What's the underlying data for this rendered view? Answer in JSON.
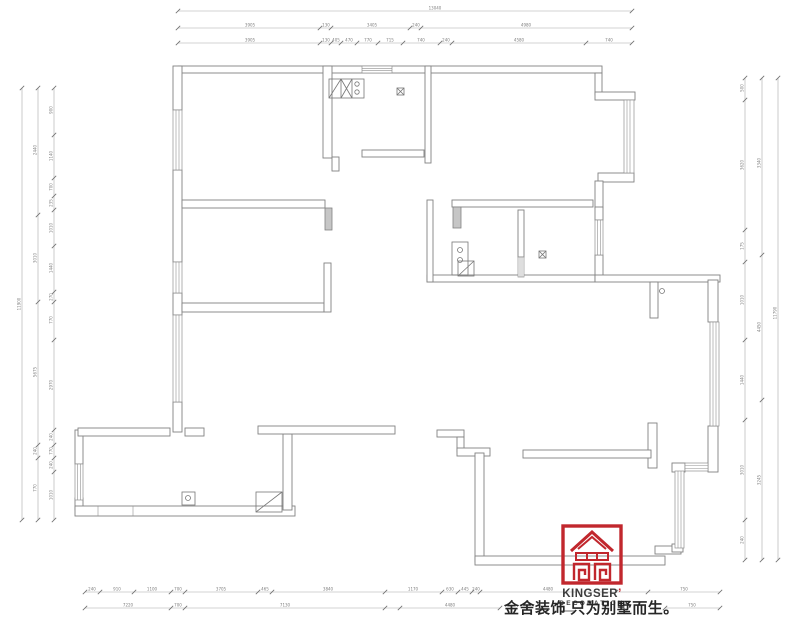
{
  "branding": {
    "logo_text_primary": "KINGSER",
    "logo_mark": "’",
    "logo_text_secondary": "DECORATION",
    "slogan": "金舍装饰 只为别墅而生。",
    "brand_red": "#c1272d",
    "text_dark": "#3d3d3d"
  },
  "floor_plan": {
    "wall_line_color": "#828282",
    "dimension_color": "#808080",
    "dimension_lines": [
      {
        "orient": "h",
        "at": 11,
        "from": 178,
        "to": 632,
        "ticks": [
          178,
          632
        ],
        "labels": [
          {
            "t": "13040",
            "pos": 435
          }
        ]
      },
      {
        "orient": "h",
        "at": 28,
        "from": 178,
        "to": 632,
        "ticks": [
          178,
          320,
          331,
          410,
          421,
          632
        ],
        "labels": [
          {
            "t": "3905",
            "pos": 250
          },
          {
            "t": "130",
            "pos": 326
          },
          {
            "t": "3405",
            "pos": 372
          },
          {
            "t": "240",
            "pos": 416
          },
          {
            "t": "4980",
            "pos": 526
          }
        ]
      },
      {
        "orient": "h",
        "at": 43,
        "from": 178,
        "to": 632,
        "ticks": [
          178,
          320,
          331,
          341,
          357,
          378,
          403,
          440,
          452,
          586,
          632
        ],
        "labels": [
          {
            "t": "3905",
            "pos": 250
          },
          {
            "t": "130",
            "pos": 326
          },
          {
            "t": "405",
            "pos": 336
          },
          {
            "t": "470",
            "pos": 349
          },
          {
            "t": "770",
            "pos": 368
          },
          {
            "t": "715",
            "pos": 390
          },
          {
            "t": "740",
            "pos": 421
          },
          {
            "t": "240",
            "pos": 446
          },
          {
            "t": "4580",
            "pos": 519
          },
          {
            "t": "740",
            "pos": 609
          }
        ]
      },
      {
        "orient": "h",
        "at": 592,
        "from": 85,
        "to": 720,
        "ticks": [
          85,
          100,
          134,
          171,
          185,
          258,
          272,
          385,
          442,
          458,
          472,
          480,
          616,
          648,
          720
        ],
        "labels": [
          {
            "t": "240",
            "pos": 92
          },
          {
            "t": "910",
            "pos": 117
          },
          {
            "t": "1100",
            "pos": 152
          },
          {
            "t": "700",
            "pos": 178
          },
          {
            "t": "3705",
            "pos": 221
          },
          {
            "t": "465",
            "pos": 265
          },
          {
            "t": "3840",
            "pos": 328
          },
          {
            "t": "1170",
            "pos": 413
          },
          {
            "t": "630",
            "pos": 450
          },
          {
            "t": "445",
            "pos": 465
          },
          {
            "t": "240",
            "pos": 476
          },
          {
            "t": "4480",
            "pos": 548
          },
          {
            "t": "750",
            "pos": 684
          }
        ]
      },
      {
        "orient": "h",
        "at": 608,
        "from": 85,
        "to": 500,
        "ticks": [
          85,
          171,
          185,
          385,
          400,
          500
        ],
        "labels": [
          {
            "t": "7220",
            "pos": 128
          },
          {
            "t": "700",
            "pos": 178
          },
          {
            "t": "7130",
            "pos": 285
          },
          {
            "t": "4480",
            "pos": 450
          }
        ]
      },
      {
        "orient": "h",
        "at": 608,
        "from": 665,
        "to": 720,
        "ticks": [
          665,
          720
        ],
        "labels": [
          {
            "t": "750",
            "pos": 692
          }
        ]
      },
      {
        "orient": "v",
        "at": 22,
        "from": 88,
        "to": 520,
        "ticks": [
          88,
          520
        ],
        "labels": [
          {
            "t": "11900",
            "pos": 304
          }
        ]
      },
      {
        "orient": "v",
        "at": 38,
        "from": 88,
        "to": 520,
        "ticks": [
          88,
          215,
          302,
          445,
          458,
          520
        ],
        "labels": [
          {
            "t": "2440",
            "pos": 150
          },
          {
            "t": "3010",
            "pos": 258
          },
          {
            "t": "5675",
            "pos": 372
          },
          {
            "t": "240",
            "pos": 451
          },
          {
            "t": "770",
            "pos": 488
          }
        ]
      },
      {
        "orient": "v",
        "at": 54,
        "from": 88,
        "to": 520,
        "ticks": [
          88,
          135,
          178,
          196,
          210,
          246,
          292,
          302,
          340,
          430,
          445,
          458,
          472,
          520
        ],
        "labels": [
          {
            "t": "900",
            "pos": 110
          },
          {
            "t": "1140",
            "pos": 156
          },
          {
            "t": "700",
            "pos": 187
          },
          {
            "t": "235",
            "pos": 203
          },
          {
            "t": "1010",
            "pos": 228
          },
          {
            "t": "1440",
            "pos": 268
          },
          {
            "t": "270",
            "pos": 297
          },
          {
            "t": "770",
            "pos": 320
          },
          {
            "t": "2970",
            "pos": 385
          },
          {
            "t": "240",
            "pos": 437
          },
          {
            "t": "770",
            "pos": 451
          },
          {
            "t": "240",
            "pos": 465
          },
          {
            "t": "1010",
            "pos": 495
          }
        ]
      },
      {
        "orient": "v",
        "at": 745,
        "from": 78,
        "to": 560,
        "ticks": [
          78,
          100,
          230,
          262,
          340,
          420,
          520,
          560
        ],
        "labels": [
          {
            "t": "500",
            "pos": 88
          },
          {
            "t": "3620",
            "pos": 165
          },
          {
            "t": "175",
            "pos": 246
          },
          {
            "t": "1010",
            "pos": 300
          },
          {
            "t": "1440",
            "pos": 380
          },
          {
            "t": "3010",
            "pos": 470
          },
          {
            "t": "240",
            "pos": 540
          }
        ]
      },
      {
        "orient": "v",
        "at": 762,
        "from": 78,
        "to": 560,
        "ticks": [
          78,
          255,
          400,
          560
        ],
        "labels": [
          {
            "t": "3340",
            "pos": 163
          },
          {
            "t": "4450",
            "pos": 327
          },
          {
            "t": "3245",
            "pos": 480
          }
        ]
      },
      {
        "orient": "v",
        "at": 778,
        "from": 78,
        "to": 560,
        "ticks": [
          78,
          560
        ],
        "labels": [
          {
            "t": "11790",
            "pos": 313
          }
        ]
      }
    ]
  }
}
